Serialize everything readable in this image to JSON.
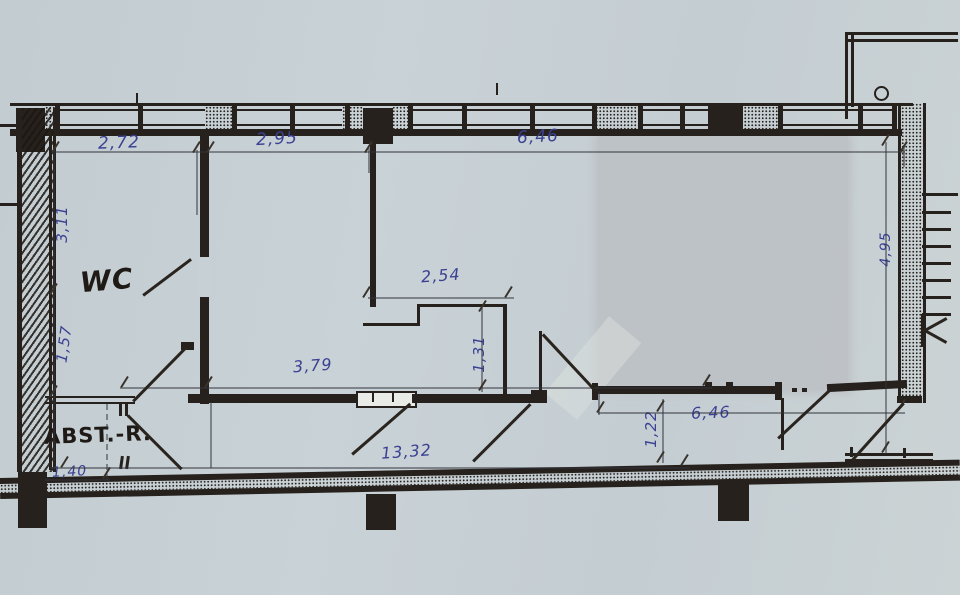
{
  "drawing_type": "hand-drawn floor plan sketch",
  "rooms": {
    "wc_label": "WC",
    "storage_label": "ABST.-R."
  },
  "dimensions": {
    "top_left": "2,72",
    "top_mid": "2,95",
    "top_right": "6,46",
    "left_upper": "3,11",
    "left_lower": "1,57",
    "mid_width": "2,54",
    "mid_height": "1,31",
    "mid_lower": "3,79",
    "bottom_total": "13,32",
    "bottom_right_width": "6,46",
    "corridor_height": "1,22",
    "bottom_left_width": "1,40",
    "right_height": "4,95"
  },
  "colors": {
    "paper": "#c6cfd3",
    "ink": "#26211c",
    "handwriting_blue": "#3b4192",
    "shade_patch": "#bdc1c5"
  }
}
